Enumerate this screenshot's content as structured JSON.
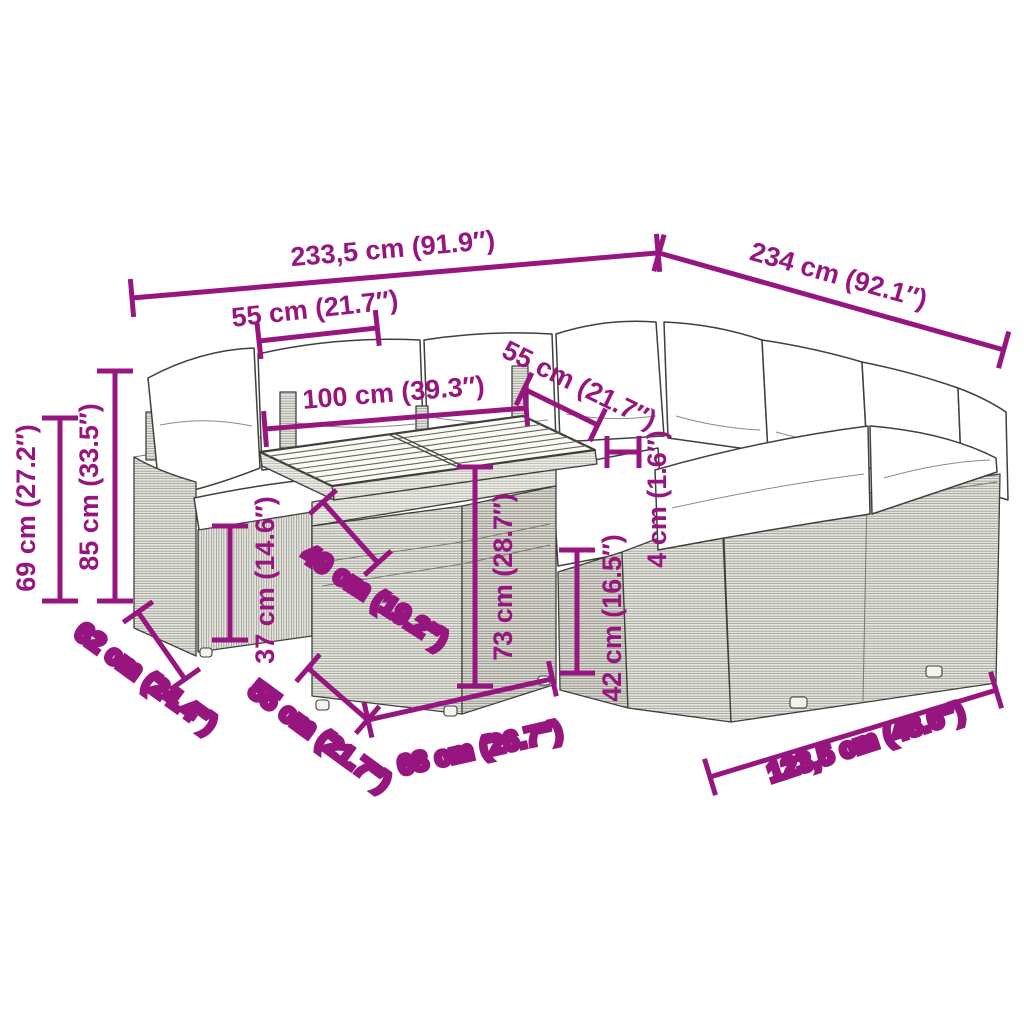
{
  "diagram": {
    "kind": "product-dimension-diagram",
    "subject": "rattan garden lounge corner sofa set with cushions and slatted-top table",
    "accent_color": "#97157E",
    "line_color": "#3F3F3C"
  },
  "dims": {
    "overall_back": "233,5 cm (91.9″)",
    "overall_right": "234 cm (92.1″)",
    "back_module": "55 cm (21.7″)",
    "table_length": "100 cm (39.3″)",
    "right_module": "55 cm (21.7″)",
    "armrest_height": "69 cm (27.2″)",
    "total_height": "85 cm (33.5″)",
    "left_depth": "62 cm (24.4″)",
    "front_module": "55 cm (21.7″)",
    "seat_height": "37 cm (14.6″)",
    "table_width": "49 cm (19.2″)",
    "table_height": "73 cm (28.7″)",
    "table_front": "68 cm (26.7″)",
    "seat_height_right": "42 cm (16.5″)",
    "cushion_thickness": "4 cm (1.6″)",
    "right_section": "123,5 cm (48.6″)"
  }
}
